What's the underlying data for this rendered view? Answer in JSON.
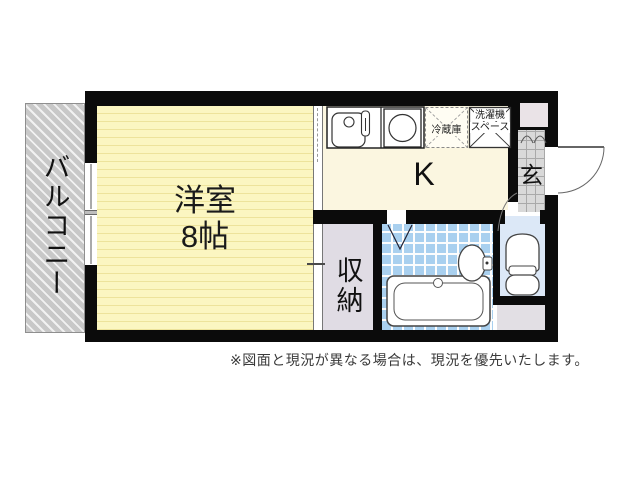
{
  "floorplan": {
    "balcony_label": "バルコニー",
    "main_room_name": "洋室",
    "main_room_size": "8帖",
    "kitchen_label": "K",
    "refrigerator_label": "冷蔵庫",
    "washer_label_line1": "洗濯機",
    "washer_label_line2": "スペース",
    "entrance_label": "玄",
    "closet_label": "収納"
  },
  "footer": {
    "disclaimer": "※図面と現況が異なる場合は、現況を優先いたします。"
  },
  "colors": {
    "wall_black": "#0b0b0b",
    "main_room_yellow": "#fbf6c1",
    "kitchen_cream": "#fbf6e0",
    "bathroom_tile_blue": "#a9d0ef",
    "toilet_floor_blue": "#dce8f7",
    "closet_lavender": "#e0dce4",
    "balcony_gray": "#c8c8c8",
    "entrance_tile_gray": "#d9d9d9",
    "shoe_cabinet_pink": "#eae3e7",
    "pipe_space_gray": "#e2dfe4"
  }
}
